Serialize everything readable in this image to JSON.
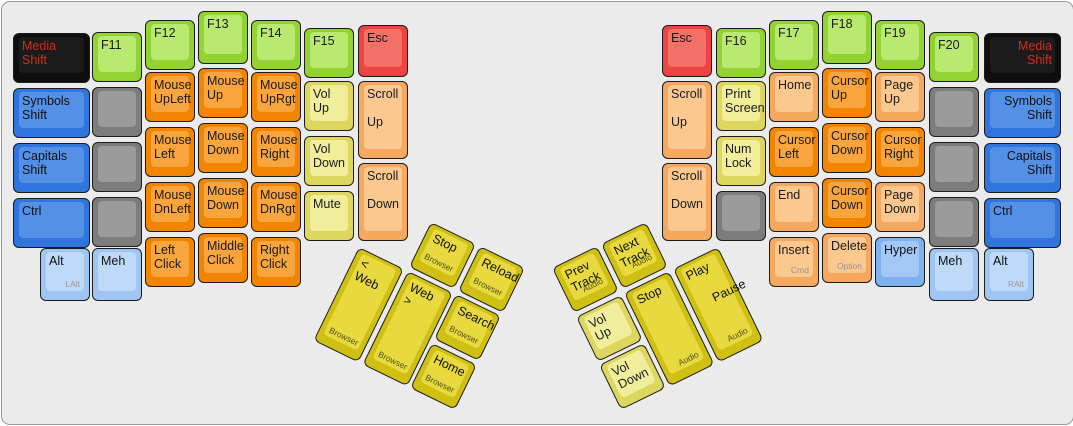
{
  "canvas": {
    "width": 1073,
    "height": 424,
    "background": "#ebebeb",
    "border_color": "#9a9a9a",
    "description": "ErgoDox keyboard layout diagram, media/mouse layer, two halves with rotated thumb clusters"
  },
  "palette": {
    "black": {
      "base": "#0e0e0e",
      "top": "#1b1b1b",
      "text": "#d6291d",
      "sub": "#8f8f8f"
    },
    "green": {
      "base": "#92d233",
      "top": "#b9e96f",
      "text": "#1a1a1a",
      "sub": "#8f8f8f"
    },
    "red": {
      "base": "#ed4343",
      "top": "#f47168",
      "text": "#1a1a1a",
      "sub": "#8f8f8f"
    },
    "blue": {
      "base": "#2f75dd",
      "top": "#5590e7",
      "text": "#111111",
      "sub": "#8f8f8f"
    },
    "lightblue": {
      "base": "#9fc6f3",
      "top": "#bedaf8",
      "text": "#111111",
      "sub": "#9a9a9a"
    },
    "hyperblue": {
      "base": "#7fb0ef",
      "top": "#a3c8f5",
      "text": "#111111",
      "sub": "#9a9a9a"
    },
    "gray": {
      "base": "#7c7c7c",
      "top": "#9b9b9b",
      "text": "#111111",
      "sub": "#666666"
    },
    "orange": {
      "base": "#f18500",
      "top": "#f9a53e",
      "text": "#1a1a1a",
      "sub": "#8f8f8f"
    },
    "lightorange": {
      "base": "#f5a95f",
      "top": "#fbc990",
      "text": "#1a1a1a",
      "sub": "#919191"
    },
    "yellow": {
      "base": "#ddd760",
      "top": "#f0ee9b",
      "text": "#1a1a1a",
      "sub": "#8f8f8f"
    },
    "gold": {
      "base": "#cfc013",
      "top": "#e7d93e",
      "text": "#111111",
      "sub": "#55511a"
    }
  },
  "keys": [
    {
      "n": "key-media-shift-left",
      "l": "Media\nShift",
      "c": "black",
      "x": 11,
      "y": 31,
      "w": 77,
      "h": 50
    },
    {
      "n": "key-symbols-shift-left",
      "l": "Symbols\nShift",
      "c": "blue",
      "x": 11,
      "y": 86,
      "w": 77,
      "h": 50
    },
    {
      "n": "key-capitals-shift-left",
      "l": "Capitals\nShift",
      "c": "blue",
      "x": 11,
      "y": 141,
      "w": 77,
      "h": 50
    },
    {
      "n": "key-ctrl-left",
      "l": "Ctrl",
      "c": "blue",
      "x": 11,
      "y": 196,
      "w": 77,
      "h": 50
    },
    {
      "n": "key-alt-left",
      "l": "Alt",
      "s": "LAlt",
      "c": "lightblue",
      "x": 38,
      "y": 246,
      "w": 50,
      "h": 53
    },
    {
      "n": "key-f11",
      "l": "F11",
      "c": "green",
      "x": 90,
      "y": 30,
      "w": 50,
      "h": 50
    },
    {
      "n": "key-blank-left-1",
      "l": "",
      "c": "gray",
      "x": 90,
      "y": 85,
      "w": 50,
      "h": 50
    },
    {
      "n": "key-blank-left-2",
      "l": "",
      "c": "gray",
      "x": 90,
      "y": 140,
      "w": 50,
      "h": 50
    },
    {
      "n": "key-blank-left-3",
      "l": "",
      "c": "gray",
      "x": 90,
      "y": 195,
      "w": 50,
      "h": 50
    },
    {
      "n": "key-meh-left",
      "l": "Meh",
      "c": "lightblue",
      "x": 90,
      "y": 246,
      "w": 50,
      "h": 53
    },
    {
      "n": "key-f12",
      "l": "F12",
      "c": "green",
      "x": 143,
      "y": 18,
      "w": 50,
      "h": 50
    },
    {
      "n": "key-mouse-upleft",
      "l": "Mouse\nUpLeft",
      "c": "orange",
      "x": 143,
      "y": 70,
      "w": 50,
      "h": 50
    },
    {
      "n": "key-mouse-left",
      "l": "Mouse\nLeft",
      "c": "orange",
      "x": 143,
      "y": 125,
      "w": 50,
      "h": 50
    },
    {
      "n": "key-mouse-dnleft",
      "l": "Mouse\nDnLeft",
      "c": "orange",
      "x": 143,
      "y": 180,
      "w": 50,
      "h": 50
    },
    {
      "n": "key-left-click",
      "l": "Left\nClick",
      "c": "orange",
      "x": 143,
      "y": 235,
      "w": 50,
      "h": 50
    },
    {
      "n": "key-f13",
      "l": "F13",
      "c": "green",
      "x": 196,
      "y": 9,
      "w": 50,
      "h": 53
    },
    {
      "n": "key-mouse-up",
      "l": "Mouse\nUp",
      "c": "orange",
      "x": 196,
      "y": 66,
      "w": 50,
      "h": 50
    },
    {
      "n": "key-mouse-down-1",
      "l": "Mouse\nDown",
      "c": "orange",
      "x": 196,
      "y": 121,
      "w": 50,
      "h": 50
    },
    {
      "n": "key-mouse-down-2",
      "l": "Mouse\nDown",
      "c": "orange",
      "x": 196,
      "y": 176,
      "w": 50,
      "h": 50
    },
    {
      "n": "key-middle-click",
      "l": "Middle\nClick",
      "c": "orange",
      "x": 196,
      "y": 231,
      "w": 50,
      "h": 50
    },
    {
      "n": "key-f14",
      "l": "F14",
      "c": "green",
      "x": 249,
      "y": 18,
      "w": 50,
      "h": 50
    },
    {
      "n": "key-mouse-uprgt",
      "l": "Mouse\nUpRgt",
      "c": "orange",
      "x": 249,
      "y": 70,
      "w": 50,
      "h": 50
    },
    {
      "n": "key-mouse-right",
      "l": "Mouse\nRight",
      "c": "orange",
      "x": 249,
      "y": 125,
      "w": 50,
      "h": 50
    },
    {
      "n": "key-mouse-dnrgt",
      "l": "Mouse\nDnRgt",
      "c": "orange",
      "x": 249,
      "y": 180,
      "w": 50,
      "h": 50
    },
    {
      "n": "key-right-click",
      "l": "Right\nClick",
      "c": "orange",
      "x": 249,
      "y": 235,
      "w": 50,
      "h": 50
    },
    {
      "n": "key-f15",
      "l": "F15",
      "c": "green",
      "x": 302,
      "y": 26,
      "w": 50,
      "h": 50
    },
    {
      "n": "key-vol-up-left",
      "l": "Vol\nUp",
      "c": "yellow",
      "x": 302,
      "y": 79,
      "w": 50,
      "h": 50
    },
    {
      "n": "key-vol-down-left",
      "l": "Vol\nDown",
      "c": "yellow",
      "x": 302,
      "y": 134,
      "w": 50,
      "h": 50
    },
    {
      "n": "key-mute",
      "l": "Mute",
      "c": "yellow",
      "x": 302,
      "y": 189,
      "w": 50,
      "h": 50
    },
    {
      "n": "key-esc-left",
      "l": "Esc",
      "c": "red",
      "x": 356,
      "y": 23,
      "w": 50,
      "h": 52
    },
    {
      "n": "key-scroll-up-left",
      "l": "Scroll",
      "m": "Up",
      "c": "lightorange",
      "x": 356,
      "y": 79,
      "w": 50,
      "h": 78
    },
    {
      "n": "key-scroll-down-left",
      "l": "Scroll",
      "m": "Down",
      "c": "lightorange",
      "x": 356,
      "y": 161,
      "w": 50,
      "h": 78
    },
    {
      "n": "key-web-back",
      "l": "< Web",
      "s": "Browser",
      "sp": "bl",
      "c": "gold",
      "x": 357,
      "y": 245,
      "w": 50,
      "h": 104,
      "r": 26
    },
    {
      "n": "key-web-forward",
      "l": "Web >",
      "s": "Browser",
      "sp": "bl",
      "c": "gold",
      "x": 406,
      "y": 269,
      "w": 50,
      "h": 104,
      "r": 26
    },
    {
      "n": "key-browser-stop",
      "l": "Stop",
      "s": "Browser",
      "sp": "bc",
      "c": "gold",
      "x": 429,
      "y": 220,
      "w": 50,
      "h": 50,
      "r": 26
    },
    {
      "n": "key-browser-reload",
      "l": "Reload",
      "s": "Browser",
      "sp": "bc",
      "c": "gold",
      "x": 478,
      "y": 244,
      "w": 50,
      "h": 50,
      "r": 26
    },
    {
      "n": "key-browser-search",
      "l": "Search",
      "s": "Browser",
      "sp": "bc",
      "c": "gold",
      "x": 454,
      "y": 292,
      "w": 50,
      "h": 50,
      "r": 26
    },
    {
      "n": "key-browser-home",
      "l": "Home",
      "s": "Browser",
      "sp": "bc",
      "c": "gold",
      "x": 430,
      "y": 341,
      "w": 50,
      "h": 50,
      "r": 26
    },
    {
      "n": "key-prev-track",
      "l": "Prev\nTrack",
      "s": "Audio",
      "c": "gold",
      "x": 550,
      "y": 266,
      "w": 50,
      "h": 50,
      "r": -26
    },
    {
      "n": "key-next-track",
      "l": "Next\nTrack",
      "s": "Audio",
      "c": "gold",
      "x": 599,
      "y": 242,
      "w": 50,
      "h": 50,
      "r": -26
    },
    {
      "n": "key-vol-up-thumb",
      "l": "Vol\nUp",
      "c": "yellow",
      "x": 574,
      "y": 315,
      "w": 50,
      "h": 50,
      "r": -26
    },
    {
      "n": "key-vol-down-thumb",
      "l": "Vol\nDown",
      "c": "yellow",
      "x": 597,
      "y": 363,
      "w": 50,
      "h": 50,
      "r": -26
    },
    {
      "n": "key-audio-stop",
      "l": "Stop",
      "s": "Audio",
      "c": "gold",
      "x": 622,
      "y": 291,
      "w": 50,
      "h": 104,
      "r": -26
    },
    {
      "n": "key-play-pause",
      "l": "Play",
      "m": "Pause",
      "mx": 14,
      "my": 18,
      "s": "Audio",
      "c": "gold",
      "x": 671,
      "y": 267,
      "w": 50,
      "h": 104,
      "r": -26
    },
    {
      "n": "key-esc-right",
      "l": "Esc",
      "c": "red",
      "x": 660,
      "y": 23,
      "w": 50,
      "h": 52
    },
    {
      "n": "key-scroll-up-right",
      "l": "Scroll",
      "m": "Up",
      "c": "lightorange",
      "x": 660,
      "y": 79,
      "w": 50,
      "h": 78
    },
    {
      "n": "key-scroll-down-right",
      "l": "Scroll",
      "m": "Down",
      "c": "lightorange",
      "x": 660,
      "y": 161,
      "w": 50,
      "h": 78
    },
    {
      "n": "key-f16",
      "l": "F16",
      "c": "green",
      "x": 714,
      "y": 26,
      "w": 50,
      "h": 50
    },
    {
      "n": "key-print-screen",
      "l": "Print\nScreen",
      "c": "yellow",
      "x": 714,
      "y": 79,
      "w": 50,
      "h": 50
    },
    {
      "n": "key-num-lock",
      "l": "Num\nLock",
      "c": "yellow",
      "x": 714,
      "y": 134,
      "w": 50,
      "h": 50
    },
    {
      "n": "key-blank-right-1",
      "l": "",
      "c": "gray",
      "x": 714,
      "y": 189,
      "w": 50,
      "h": 50
    },
    {
      "n": "key-f17",
      "l": "F17",
      "c": "green",
      "x": 767,
      "y": 18,
      "w": 50,
      "h": 50
    },
    {
      "n": "key-home",
      "l": "Home",
      "c": "lightorange",
      "x": 767,
      "y": 70,
      "w": 50,
      "h": 50
    },
    {
      "n": "key-cursor-left",
      "l": "Cursor\nLeft",
      "c": "orange",
      "x": 767,
      "y": 125,
      "w": 50,
      "h": 50
    },
    {
      "n": "key-end",
      "l": "End",
      "c": "lightorange",
      "x": 767,
      "y": 180,
      "w": 50,
      "h": 50
    },
    {
      "n": "key-insert",
      "l": "Insert",
      "s": "Cmd",
      "c": "lightorange",
      "x": 767,
      "y": 235,
      "w": 50,
      "h": 50
    },
    {
      "n": "key-f18",
      "l": "F18",
      "c": "green",
      "x": 820,
      "y": 9,
      "w": 50,
      "h": 53
    },
    {
      "n": "key-cursor-up",
      "l": "Cursor\nUp",
      "c": "orange",
      "x": 820,
      "y": 66,
      "w": 50,
      "h": 50
    },
    {
      "n": "key-cursor-down-1",
      "l": "Cursor\nDown",
      "c": "orange",
      "x": 820,
      "y": 121,
      "w": 50,
      "h": 50
    },
    {
      "n": "key-cursor-down-2",
      "l": "Cursor\nDown",
      "c": "orange",
      "x": 820,
      "y": 176,
      "w": 50,
      "h": 50
    },
    {
      "n": "key-delete",
      "l": "Delete",
      "s": "Option",
      "c": "lightorange",
      "x": 820,
      "y": 231,
      "w": 50,
      "h": 50
    },
    {
      "n": "key-f19",
      "l": "F19",
      "c": "green",
      "x": 873,
      "y": 18,
      "w": 50,
      "h": 50
    },
    {
      "n": "key-page-up",
      "l": "Page\nUp",
      "c": "lightorange",
      "x": 873,
      "y": 70,
      "w": 50,
      "h": 50
    },
    {
      "n": "key-cursor-right",
      "l": "Cursor\nRight",
      "c": "orange",
      "x": 873,
      "y": 125,
      "w": 50,
      "h": 50
    },
    {
      "n": "key-page-down",
      "l": "Page\nDown",
      "c": "lightorange",
      "x": 873,
      "y": 180,
      "w": 50,
      "h": 50
    },
    {
      "n": "key-hyper",
      "l": "Hyper",
      "c": "hyperblue",
      "x": 873,
      "y": 235,
      "w": 50,
      "h": 50
    },
    {
      "n": "key-f20",
      "l": "F20",
      "c": "green",
      "x": 927,
      "y": 30,
      "w": 50,
      "h": 50
    },
    {
      "n": "key-blank-right-2",
      "l": "",
      "c": "gray",
      "x": 927,
      "y": 85,
      "w": 50,
      "h": 50
    },
    {
      "n": "key-blank-right-3",
      "l": "",
      "c": "gray",
      "x": 927,
      "y": 140,
      "w": 50,
      "h": 50
    },
    {
      "n": "key-blank-right-4",
      "l": "",
      "c": "gray",
      "x": 927,
      "y": 195,
      "w": 50,
      "h": 50
    },
    {
      "n": "key-meh-right",
      "l": "Meh",
      "c": "lightblue",
      "x": 927,
      "y": 246,
      "w": 50,
      "h": 53
    },
    {
      "n": "key-media-shift-right",
      "l": "Media\nShift",
      "a": "right",
      "c": "black",
      "x": 982,
      "y": 31,
      "w": 77,
      "h": 50
    },
    {
      "n": "key-symbols-shift-right",
      "l": "Symbols\nShift",
      "a": "right",
      "c": "blue",
      "x": 982,
      "y": 86,
      "w": 77,
      "h": 50
    },
    {
      "n": "key-capitals-shift-right",
      "l": "Capitals\nShift",
      "a": "right",
      "c": "blue",
      "x": 982,
      "y": 141,
      "w": 77,
      "h": 50
    },
    {
      "n": "key-ctrl-right",
      "l": "Ctrl",
      "c": "blue",
      "x": 982,
      "y": 196,
      "w": 77,
      "h": 50
    },
    {
      "n": "key-alt-right",
      "l": "Alt",
      "s": "RAlt",
      "c": "lightblue",
      "x": 982,
      "y": 246,
      "w": 50,
      "h": 53
    }
  ]
}
